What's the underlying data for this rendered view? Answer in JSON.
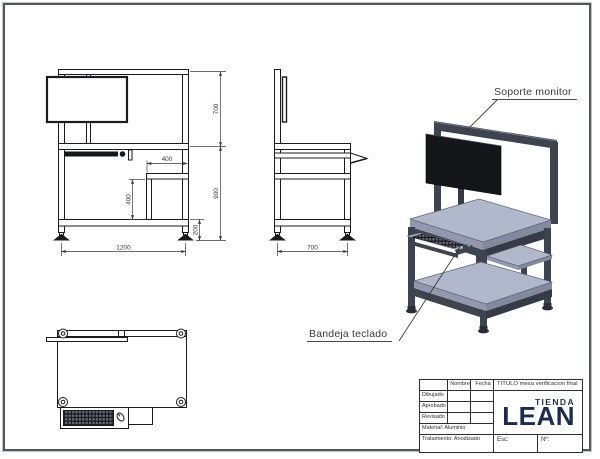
{
  "drawing": {
    "annotations": {
      "monitor_support": "Soporte monitor",
      "keyboard_tray": "Bandeja teclado"
    },
    "front_view": {
      "dim_upper_height": "700",
      "dim_lower_height": "900",
      "dim_shelf_width": "400",
      "dim_shelf_height": "400",
      "dim_foot_clearance": "200",
      "dim_total_width": "1200"
    },
    "side_view": {
      "dim_depth": "700"
    }
  },
  "title_block": {
    "name_header": "Nombre",
    "date_header": "Fecha",
    "rows": [
      "Dibujado",
      "Aprobado",
      "Revisado"
    ],
    "material": "Material: Aluminio",
    "treatment": "Tratamiento:  Anodizado",
    "title": "TITULO mesa verificacion final",
    "brand_top": "TIENDA",
    "brand_main": "LEAN",
    "scale_label": "Esc:",
    "number_label": "Nº:"
  },
  "colors": {
    "frame_dark": "#3e4350",
    "surface_light": "#b2b8cb",
    "monitor_black": "#15161a",
    "brand_navy": "#1d2b4d",
    "line_black": "#1b1b1d",
    "dim_gray": "#3b3b3b"
  }
}
